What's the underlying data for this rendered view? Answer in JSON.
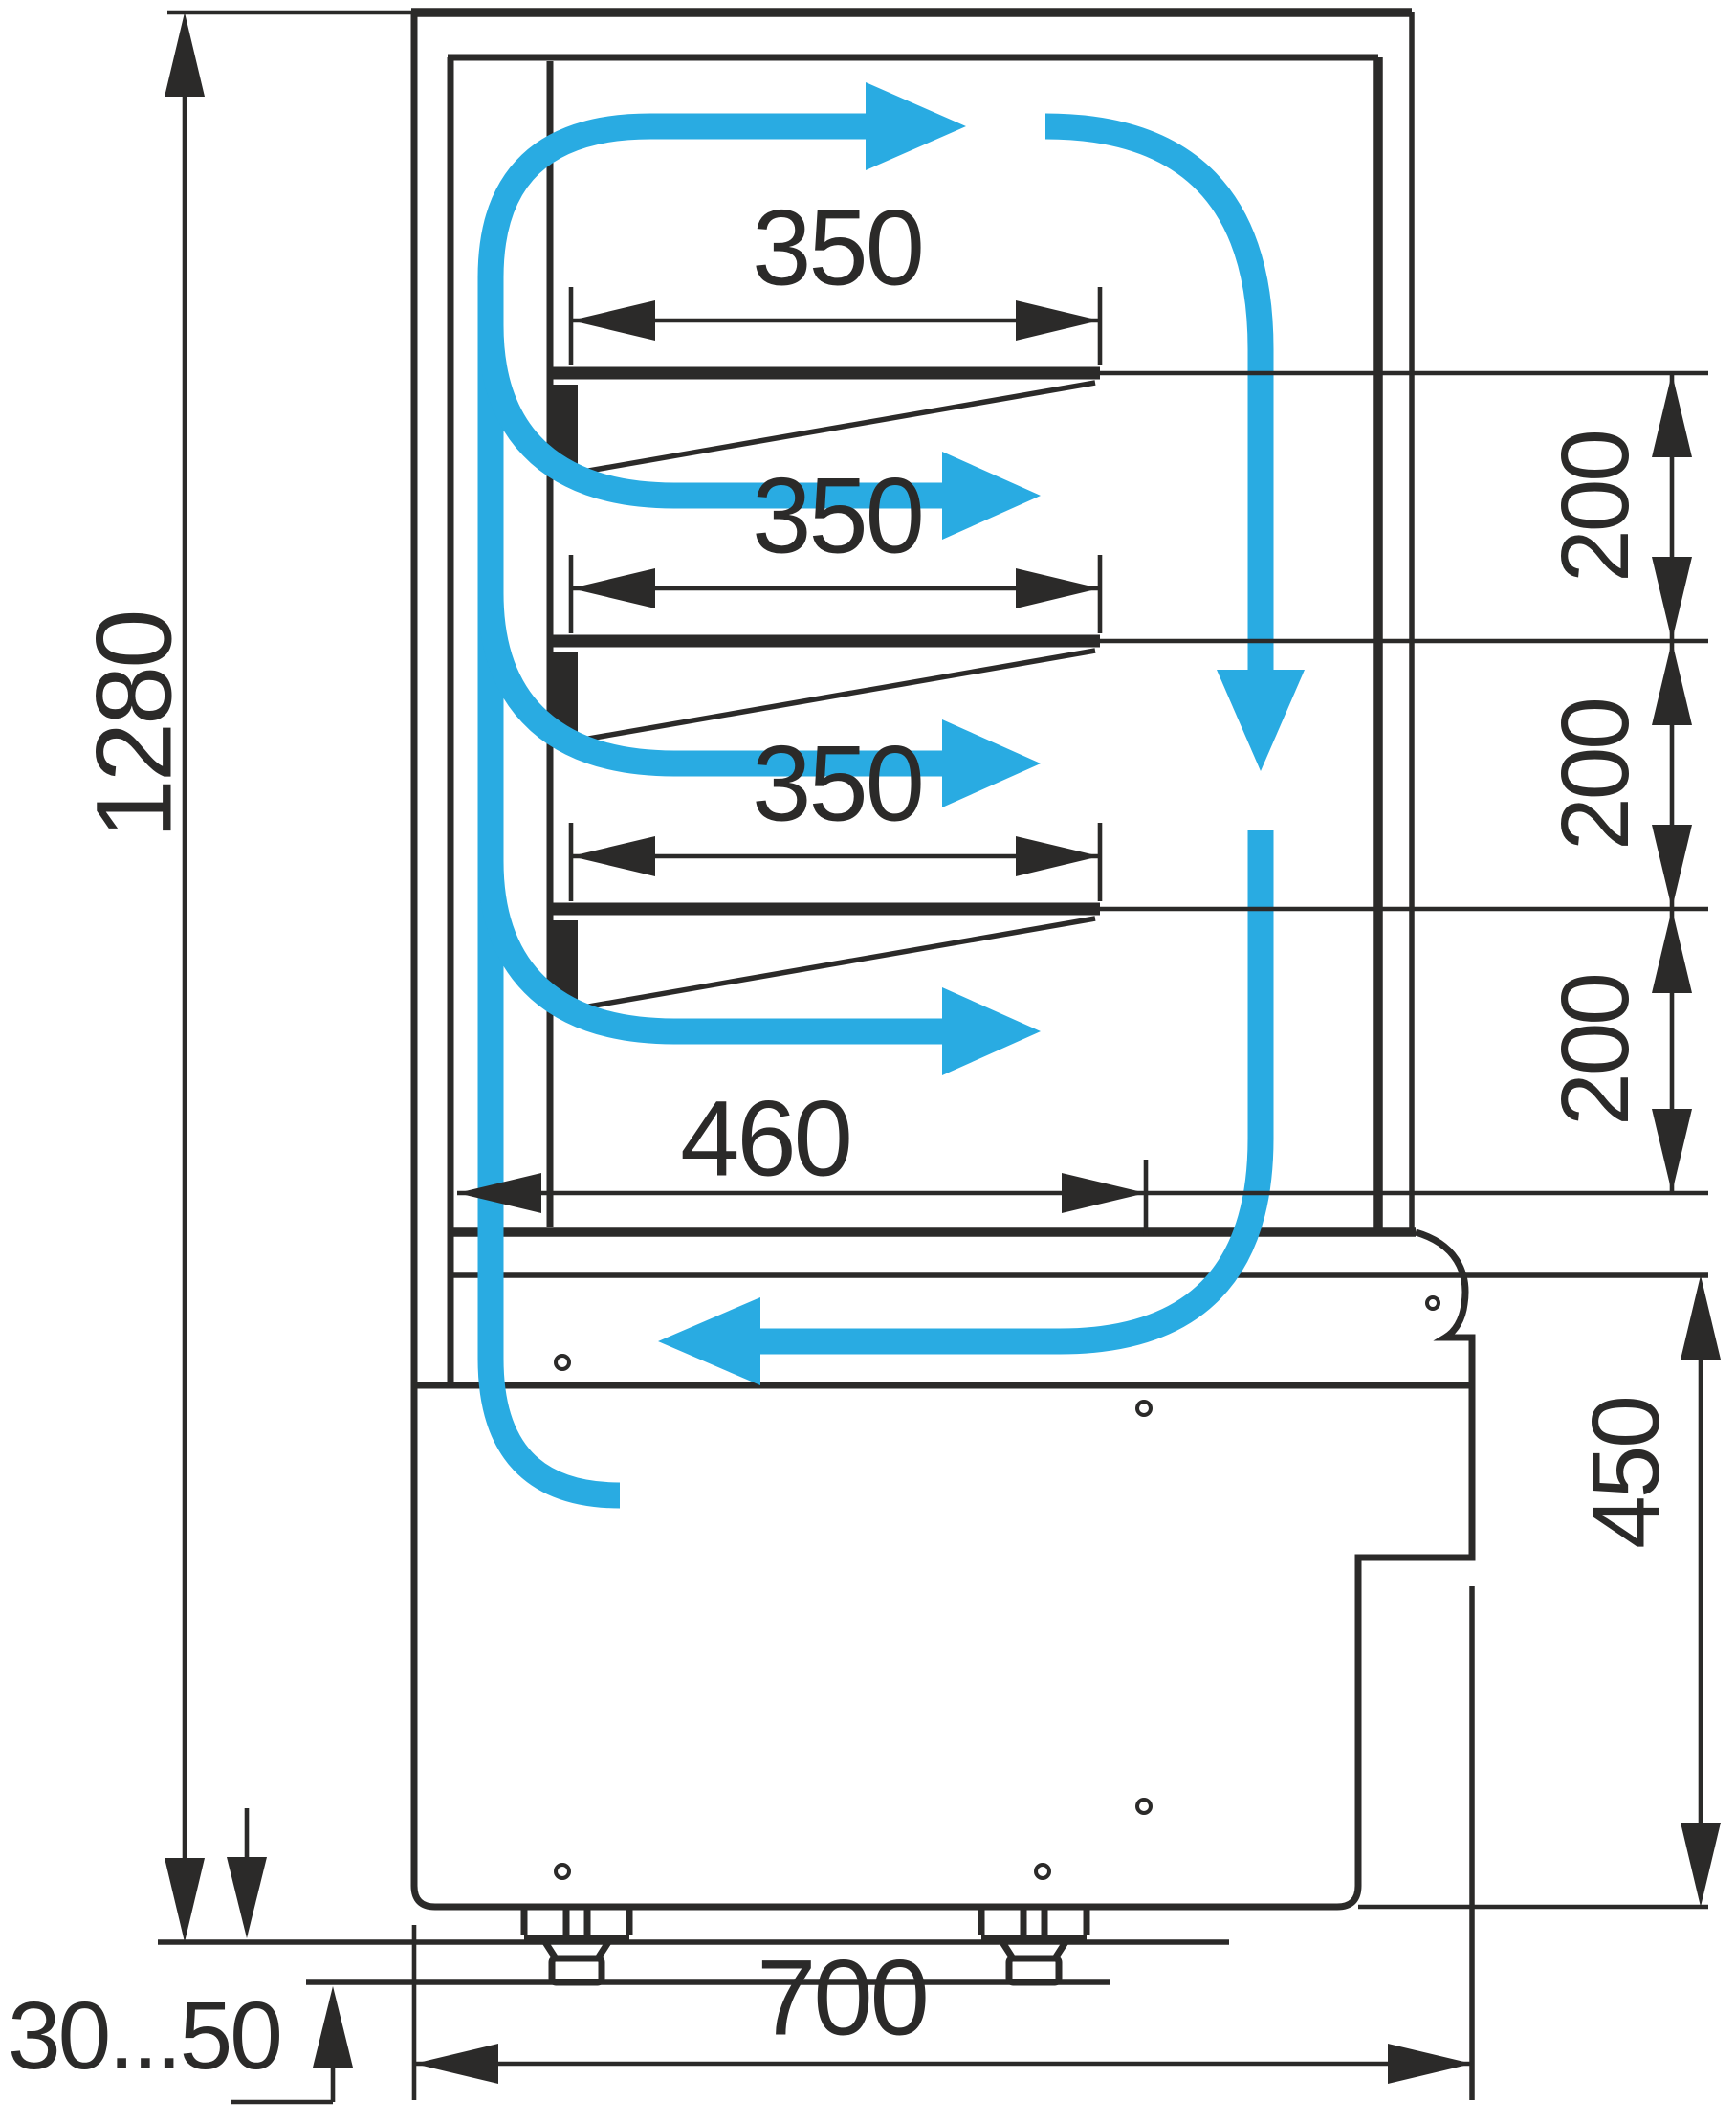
{
  "title": "Refrigerated pastry display case - side cross-section drawing",
  "colors": {
    "ink": "#2b2a29",
    "airflow": "#29abe2",
    "background": "#ffffff"
  },
  "dimensions": {
    "total_height": "1280",
    "shelf1_depth": "350",
    "shelf2_depth": "350",
    "shelf3_depth": "350",
    "deck_depth": "460",
    "spacing_1_2": "200",
    "spacing_2_3": "200",
    "spacing_3_deck": "200",
    "base_height": "450",
    "overall_depth": "700",
    "leg_adjust_range": "30...50"
  },
  "icons": {
    "airflow_arrows": "blue arrows showing cold air circulation loop",
    "dimension_arrows": "black filled dimension arrowheads"
  }
}
